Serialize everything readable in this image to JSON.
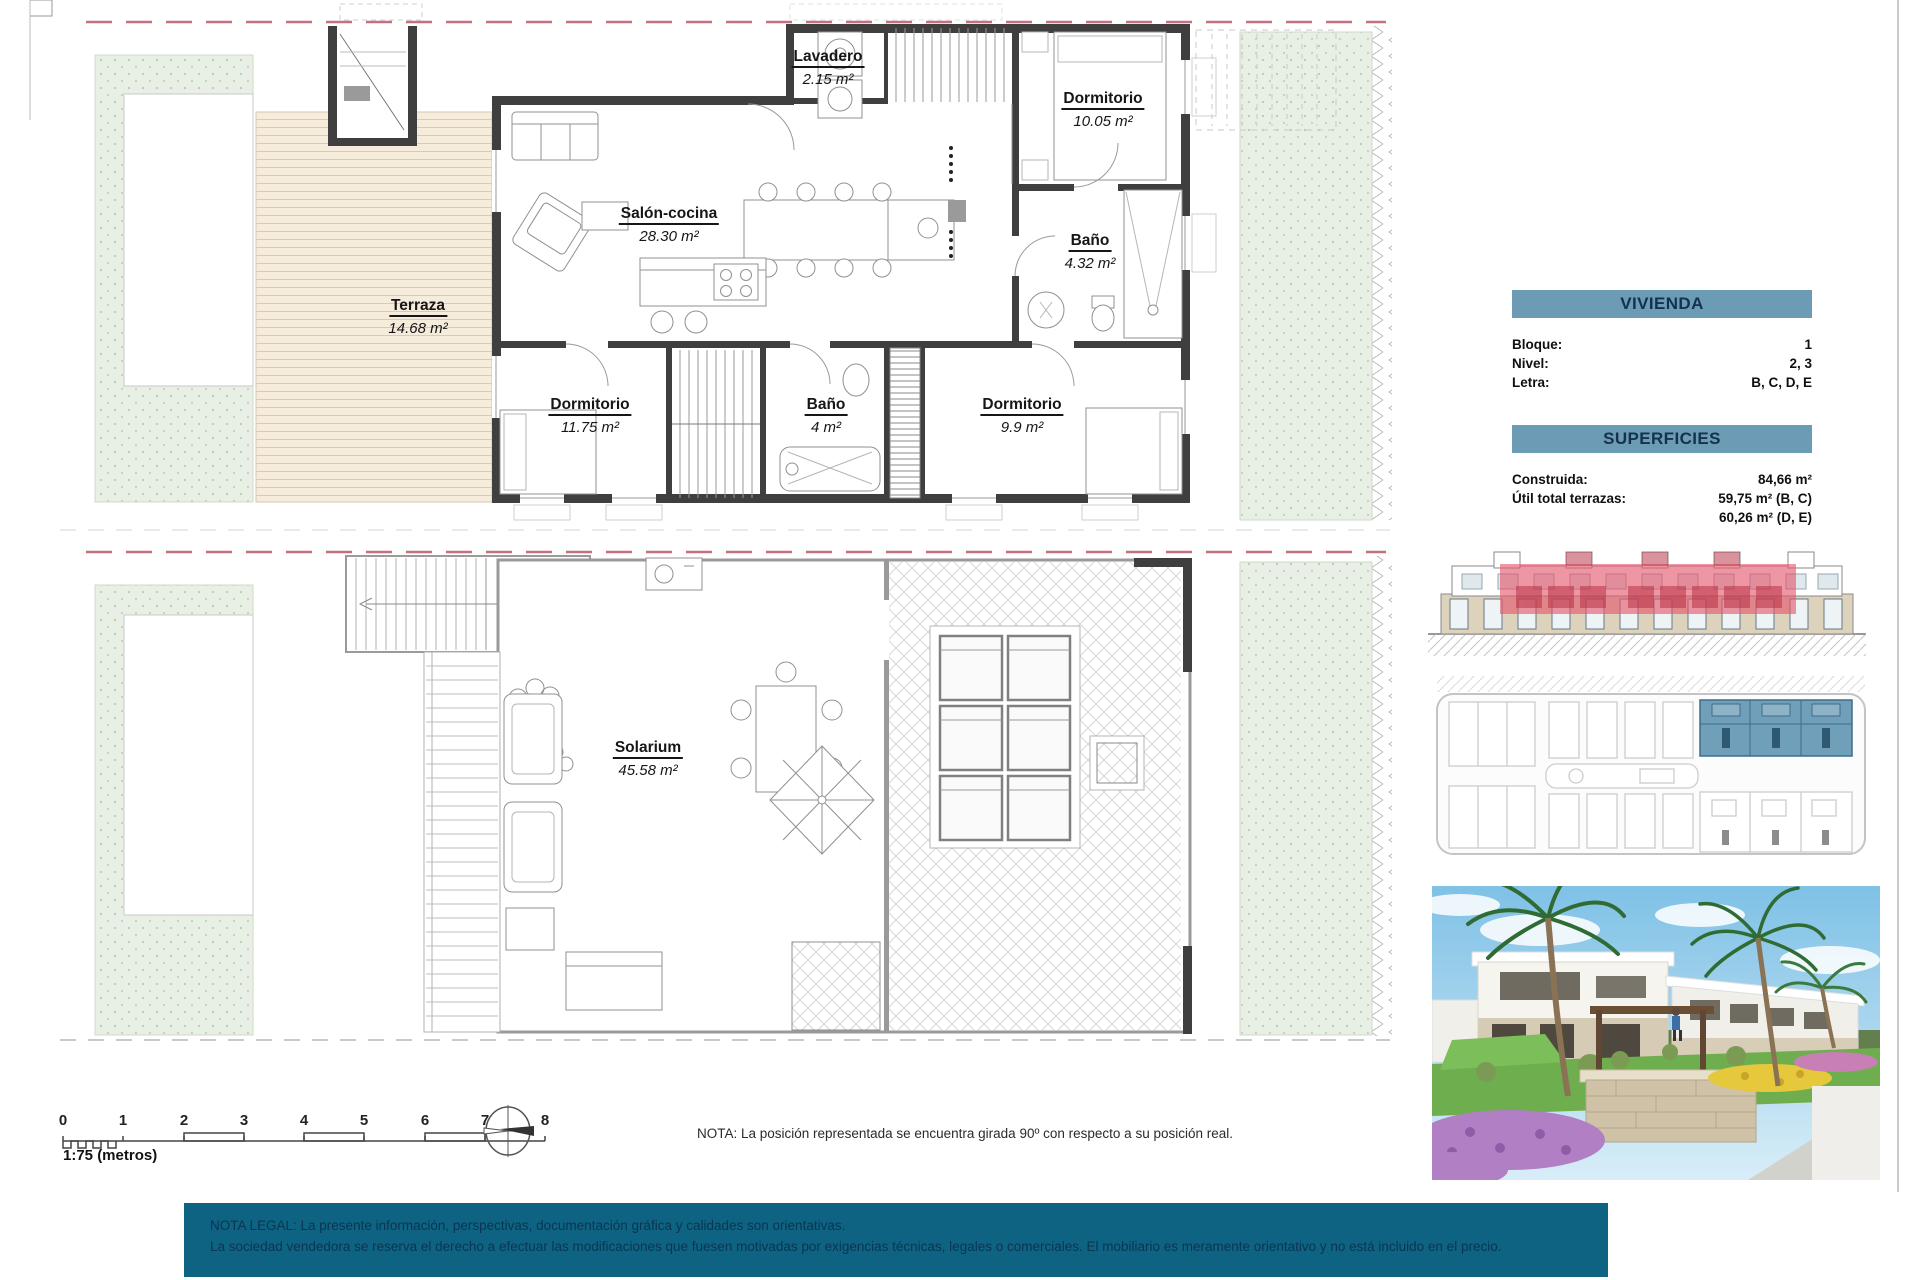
{
  "sheet": {
    "floor_plan": {
      "rooms": [
        {
          "name": "Lavadero",
          "area": "2.15 m²"
        },
        {
          "name": "Dormitorio",
          "area": "10.05 m²"
        },
        {
          "name": "Salón-cocina",
          "area": "28.30 m²"
        },
        {
          "name": "Baño",
          "area": "4.32 m²"
        },
        {
          "name": "Terraza",
          "area": "14.68 m²"
        },
        {
          "name": "Dormitorio",
          "area": "11.75 m²"
        },
        {
          "name": "Baño",
          "area": "4 m²"
        },
        {
          "name": "Dormitorio",
          "area": "9.9 m²"
        }
      ]
    },
    "solarium_plan": {
      "rooms": [
        {
          "name": "Solarium",
          "area": "45.58 m²"
        }
      ]
    }
  },
  "info": {
    "vivienda": {
      "title": "VIVIENDA",
      "bloque_label": "Bloque:",
      "bloque_value": "1",
      "nivel_label": "Nivel:",
      "nivel_value": "2, 3",
      "letra_label": "Letra:",
      "letra_value": "B, C, D, E"
    },
    "superficies": {
      "title": "SUPERFICIES",
      "construida_label": "Construida:",
      "construida_value": "84,66 m²",
      "util_label": "Útil total terrazas:",
      "util_value_bc": "59,75 m² (B, C)",
      "util_value_de": "60,26 m² (D, E)"
    }
  },
  "scalebar": {
    "ticks": [
      "0",
      "1",
      "2",
      "3",
      "4",
      "5",
      "6",
      "7",
      "8"
    ],
    "caption": "1:75 (metros)"
  },
  "nota": "NOTA: La posición representada se encuentra girada 90º con respecto a su posición real.",
  "footer": {
    "line1": "NOTA LEGAL: La presente información, perspectivas, documentación gráfica y calidades son orientativas.",
    "line2": "La sociedad vendedora se reserva el derecho a efectuar las modificaciones que fuesen motivadas por exigencias técnicas, legales o comerciales. El mobiliario es meramente orientativo y no está incluido en el precio."
  },
  "colors": {
    "panel_header": "#6C9CB5",
    "footer_bg": "#0e6383",
    "highlight_red": "#e4556a",
    "highlight_blue": "#6f9fb9",
    "boundary_dash": "#c4717f"
  }
}
